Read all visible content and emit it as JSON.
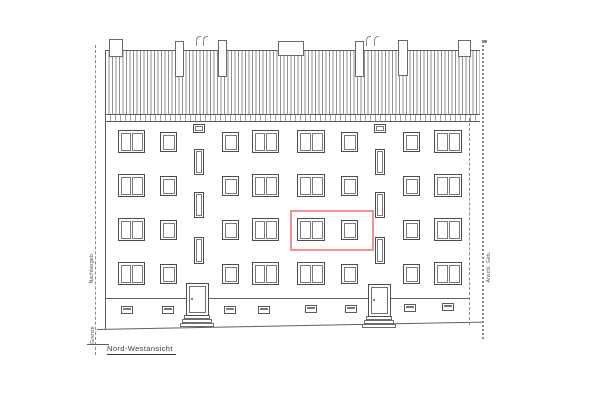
{
  "labels": {
    "view_title": "Nord-Westansicht",
    "left_top": "Nachbargeb.",
    "left_bottom": "Grenze",
    "right": "Anschl. Geb."
  },
  "colors": {
    "paper": "#ffffff",
    "ink": "#555555",
    "ink_light": "#8a8a8a",
    "highlight_red": "#f19191"
  },
  "drawing": {
    "roof": {
      "x": 105,
      "y": 50,
      "w": 375,
      "h": 64
    },
    "eave": {
      "x": 105,
      "y": 114,
      "w": 375,
      "h": 8
    },
    "chimneys": [
      {
        "x": 109,
        "y": 39,
        "w": 14,
        "h": 18
      },
      {
        "x": 175,
        "y": 41,
        "w": 9,
        "h": 36
      },
      {
        "x": 218,
        "y": 40,
        "w": 9,
        "h": 37
      },
      {
        "x": 278,
        "y": 41,
        "w": 26,
        "h": 15
      },
      {
        "x": 355,
        "y": 41,
        "w": 9,
        "h": 36
      },
      {
        "x": 398,
        "y": 40,
        "w": 10,
        "h": 36
      },
      {
        "x": 458,
        "y": 40,
        "w": 13,
        "h": 17
      }
    ],
    "vents": [
      {
        "x": 196,
        "y": 36
      },
      {
        "x": 203,
        "y": 36
      },
      {
        "x": 366,
        "y": 36
      },
      {
        "x": 374,
        "y": 36
      }
    ],
    "window_grid": {
      "row_tops": [
        130,
        174,
        218,
        262
      ],
      "double_cols": [
        {
          "x": 118,
          "w": 27
        },
        {
          "x": 252,
          "w": 27
        },
        {
          "x": 297,
          "w": 28
        },
        {
          "x": 434,
          "w": 28
        }
      ],
      "single_cols": [
        {
          "x": 160,
          "w": 17
        },
        {
          "x": 222,
          "w": 17
        },
        {
          "x": 341,
          "w": 17
        },
        {
          "x": 403,
          "w": 17
        }
      ],
      "double_h": 23,
      "single_h": 20,
      "single_dy": 2
    },
    "stair_small": [
      {
        "x": 193,
        "y": 124,
        "w": 12,
        "h": 9
      },
      {
        "x": 374,
        "y": 124,
        "w": 12,
        "h": 9
      }
    ],
    "stair_tall": [
      {
        "x": 194,
        "y": 149,
        "w": 10,
        "h": 26
      },
      {
        "x": 194,
        "y": 192,
        "w": 10,
        "h": 26
      },
      {
        "x": 194,
        "y": 237,
        "w": 10,
        "h": 27
      },
      {
        "x": 375,
        "y": 149,
        "w": 10,
        "h": 26
      },
      {
        "x": 375,
        "y": 192,
        "w": 10,
        "h": 26
      },
      {
        "x": 375,
        "y": 237,
        "w": 10,
        "h": 27
      }
    ],
    "doors": [
      {
        "x": 186,
        "y": 283,
        "w": 23,
        "h": 33
      },
      {
        "x": 368,
        "y": 284,
        "w": 23,
        "h": 33
      }
    ],
    "steps": [
      {
        "x": 184,
        "y": 315,
        "w": 26,
        "h": 4
      },
      {
        "x": 182,
        "y": 319,
        "w": 30,
        "h": 4
      },
      {
        "x": 180,
        "y": 323,
        "w": 34,
        "h": 4
      },
      {
        "x": 366,
        "y": 316,
        "w": 26,
        "h": 4
      },
      {
        "x": 364,
        "y": 320,
        "w": 30,
        "h": 4
      },
      {
        "x": 362,
        "y": 324,
        "w": 34,
        "h": 4
      }
    ],
    "basement_windows": [
      {
        "x": 121,
        "y": 306
      },
      {
        "x": 162,
        "y": 306
      },
      {
        "x": 224,
        "y": 306
      },
      {
        "x": 258,
        "y": 306
      },
      {
        "x": 305,
        "y": 305
      },
      {
        "x": 345,
        "y": 305
      },
      {
        "x": 404,
        "y": 304
      },
      {
        "x": 442,
        "y": 303
      }
    ],
    "basement_w": 12,
    "basement_h": 8,
    "lines": [
      {
        "name": "plinth-line",
        "kind": "solid",
        "dir": "h",
        "x": 105,
        "y": 298,
        "len": 365
      },
      {
        "name": "ground-line",
        "kind": "solid",
        "dir": "h",
        "x": 97,
        "y": 329,
        "len": 386,
        "angle": -1.1
      },
      {
        "name": "building-left-edge",
        "kind": "solid",
        "dir": "v",
        "x": 105,
        "y": 50,
        "len": 279
      },
      {
        "name": "building-right-hidden-edge",
        "kind": "dashed",
        "dir": "v",
        "x": 469,
        "y": 118,
        "len": 204
      },
      {
        "name": "left-boundary-line",
        "kind": "dashed",
        "dir": "v",
        "x": 95,
        "y": 45,
        "len": 307
      },
      {
        "name": "right-boundary-line",
        "kind": "dotted",
        "dir": "v",
        "x": 482,
        "y": 40,
        "len": 296
      },
      {
        "name": "left-boundary-tick",
        "kind": "solid",
        "dir": "h",
        "x": 87,
        "y": 344,
        "len": 22
      }
    ],
    "highlight_box": {
      "x": 290,
      "y": 210,
      "w": 84,
      "h": 41
    }
  }
}
